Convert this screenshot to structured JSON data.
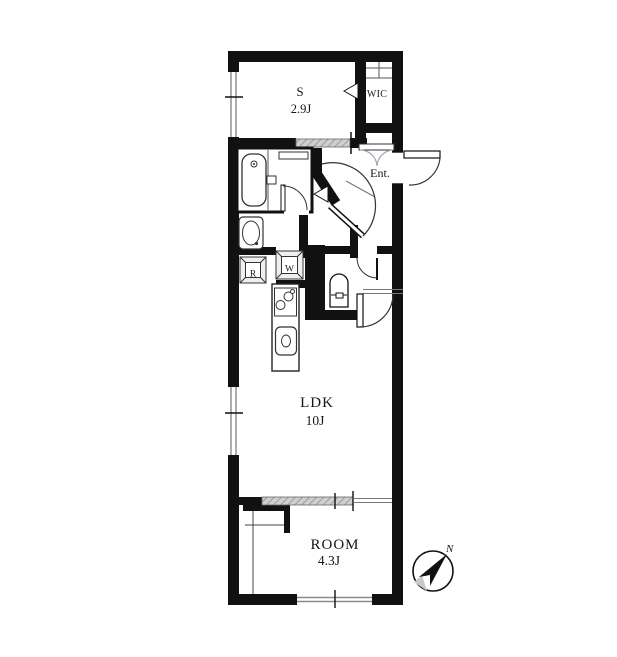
{
  "rooms": {
    "service": {
      "label": "S",
      "size": "2.9J"
    },
    "wic": {
      "label": "WIC"
    },
    "entrance": {
      "label": "Ent."
    },
    "ldk": {
      "label": "LDK",
      "size": "10J"
    },
    "bedroom": {
      "label": "ROOM",
      "size": "4.3J"
    }
  },
  "appliance_spaces": {
    "refrigerator": "R",
    "washer": "W"
  },
  "compass": {
    "north_label": "N"
  },
  "colors": {
    "wall": "#111111",
    "fixture_line": "#333333",
    "window_line": "#8a8a8a",
    "sliding_hatch": "#cfcfcf",
    "background": "#ffffff"
  }
}
